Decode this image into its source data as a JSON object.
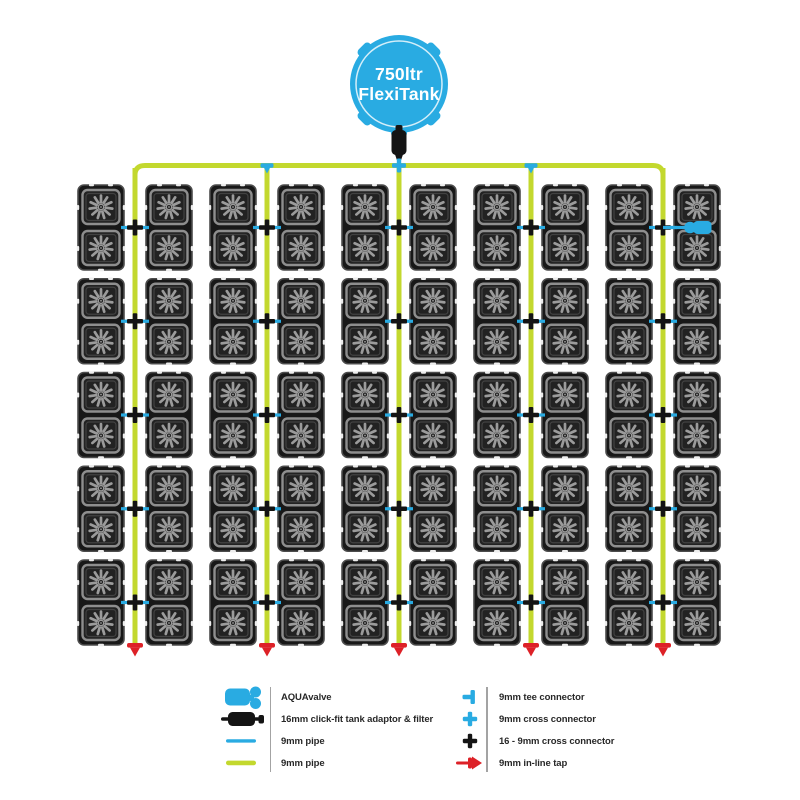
{
  "system": {
    "tank": {
      "line1": "750ltr",
      "line2": "FlexiTank"
    },
    "layout": {
      "vertical_pipes": 5,
      "tray_rows": 5,
      "trays_per_row_per_pipe": 2,
      "pots_per_tray": 2,
      "total_pots": 100
    },
    "aquavalve": {
      "pipe_index": 5,
      "row": 1,
      "side": "right"
    }
  },
  "colors": {
    "pipe_blue": "#29abe2",
    "pipe_yellow": "#c3d82e",
    "tap_red": "#dd2127",
    "connector_black": "#141414",
    "tray_fill": "#181818",
    "tray_stroke": "#4c4c4c",
    "pot_stroke": "#8e8e8e",
    "flower_gray": "#9b9b9b",
    "notch_white": "#ededed"
  },
  "legend": {
    "left": [
      {
        "icon": "aquavalve-icon",
        "label": "AQUAvalve"
      },
      {
        "icon": "tank-adaptor-icon",
        "label": "16mm click-fit tank adaptor & filter"
      },
      {
        "icon": "pipe-blue-icon",
        "label": "9mm pipe"
      },
      {
        "icon": "pipe-yellow-icon",
        "label": "9mm pipe"
      }
    ],
    "right": [
      {
        "icon": "tee-connector-icon",
        "label": "9mm tee connector"
      },
      {
        "icon": "cross-connector-icon",
        "label": "9mm cross connector"
      },
      {
        "icon": "cross-16-9-icon",
        "label": "16 - 9mm cross connector"
      },
      {
        "icon": "inline-tap-icon",
        "label": "9mm in-line tap"
      }
    ]
  }
}
